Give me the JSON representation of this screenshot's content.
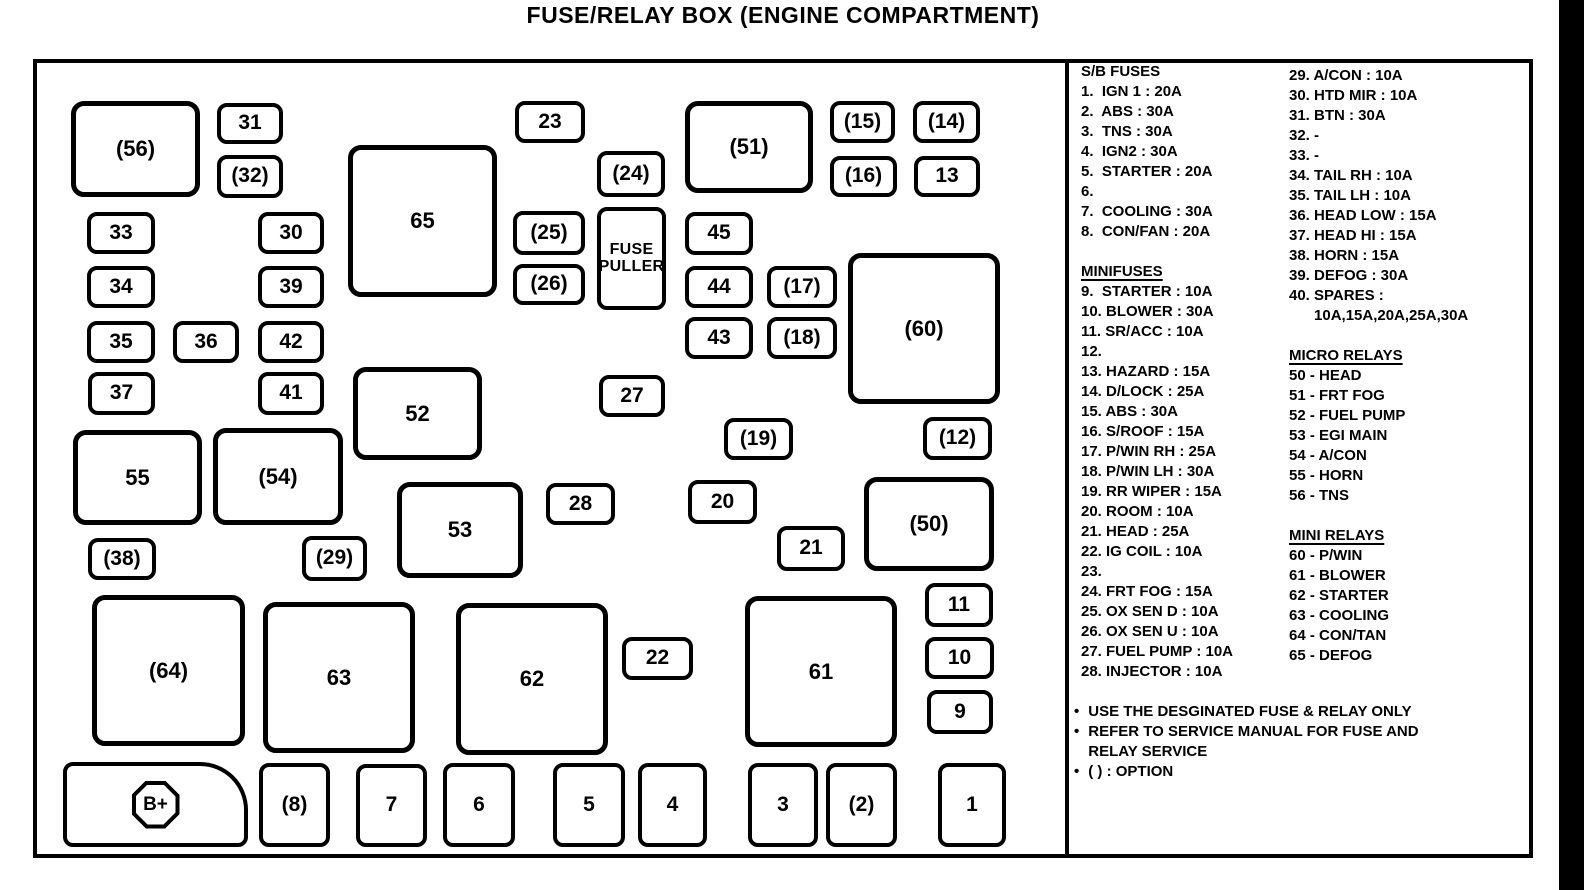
{
  "title": "FUSE/RELAY BOX (ENGINE COMPARTMENT)",
  "colors": {
    "ink": "#000000",
    "paper": "#ffffff"
  },
  "boxes": [
    {
      "id": "56",
      "label": "(56)",
      "x": 71,
      "y": 101,
      "w": 129,
      "h": 96,
      "large": true
    },
    {
      "id": "31",
      "label": "31",
      "x": 217,
      "y": 103,
      "w": 66,
      "h": 41
    },
    {
      "id": "32",
      "label": "(32)",
      "x": 217,
      "y": 155,
      "w": 66,
      "h": 43
    },
    {
      "id": "33",
      "label": "33",
      "x": 87,
      "y": 212,
      "w": 68,
      "h": 42
    },
    {
      "id": "30",
      "label": "30",
      "x": 258,
      "y": 212,
      "w": 66,
      "h": 42
    },
    {
      "id": "34",
      "label": "34",
      "x": 87,
      "y": 266,
      "w": 68,
      "h": 42
    },
    {
      "id": "39",
      "label": "39",
      "x": 258,
      "y": 266,
      "w": 66,
      "h": 42
    },
    {
      "id": "35",
      "label": "35",
      "x": 87,
      "y": 321,
      "w": 68,
      "h": 42
    },
    {
      "id": "36",
      "label": "36",
      "x": 173,
      "y": 321,
      "w": 66,
      "h": 42
    },
    {
      "id": "42",
      "label": "42",
      "x": 258,
      "y": 321,
      "w": 66,
      "h": 42
    },
    {
      "id": "37",
      "label": "37",
      "x": 88,
      "y": 372,
      "w": 67,
      "h": 43
    },
    {
      "id": "41",
      "label": "41",
      "x": 258,
      "y": 372,
      "w": 66,
      "h": 43
    },
    {
      "id": "65",
      "label": "65",
      "x": 348,
      "y": 145,
      "w": 149,
      "h": 152,
      "large": true
    },
    {
      "id": "52",
      "label": "52",
      "x": 353,
      "y": 367,
      "w": 129,
      "h": 93,
      "large": true
    },
    {
      "id": "23",
      "label": "23",
      "x": 515,
      "y": 101,
      "w": 70,
      "h": 42
    },
    {
      "id": "24",
      "label": "(24)",
      "x": 597,
      "y": 151,
      "w": 68,
      "h": 46
    },
    {
      "id": "51",
      "label": "(51)",
      "x": 685,
      "y": 101,
      "w": 128,
      "h": 92,
      "large": true
    },
    {
      "id": "15",
      "label": "(15)",
      "x": 830,
      "y": 101,
      "w": 65,
      "h": 42
    },
    {
      "id": "14",
      "label": "(14)",
      "x": 913,
      "y": 101,
      "w": 67,
      "h": 42
    },
    {
      "id": "16",
      "label": "(16)",
      "x": 830,
      "y": 156,
      "w": 67,
      "h": 41
    },
    {
      "id": "13",
      "label": "13",
      "x": 914,
      "y": 156,
      "w": 66,
      "h": 41
    },
    {
      "id": "25",
      "label": "(25)",
      "x": 513,
      "y": 211,
      "w": 72,
      "h": 44
    },
    {
      "id": "fuse-puller",
      "label": "FUSE PULLER",
      "lines": [
        "FUSE",
        "PULLER"
      ],
      "x": 597,
      "y": 207,
      "w": 69,
      "h": 103,
      "puller": true
    },
    {
      "id": "45",
      "label": "45",
      "x": 685,
      "y": 212,
      "w": 68,
      "h": 43
    },
    {
      "id": "26",
      "label": "(26)",
      "x": 513,
      "y": 264,
      "w": 72,
      "h": 41
    },
    {
      "id": "44",
      "label": "44",
      "x": 685,
      "y": 266,
      "w": 68,
      "h": 42
    },
    {
      "id": "17",
      "label": "(17)",
      "x": 767,
      "y": 266,
      "w": 70,
      "h": 42
    },
    {
      "id": "43",
      "label": "43",
      "x": 685,
      "y": 317,
      "w": 68,
      "h": 42
    },
    {
      "id": "18",
      "label": "(18)",
      "x": 767,
      "y": 317,
      "w": 70,
      "h": 42
    },
    {
      "id": "60",
      "label": "(60)",
      "x": 848,
      "y": 253,
      "w": 152,
      "h": 151,
      "large": true
    },
    {
      "id": "27",
      "label": "27",
      "x": 599,
      "y": 375,
      "w": 66,
      "h": 42
    },
    {
      "id": "19",
      "label": "(19)",
      "x": 724,
      "y": 418,
      "w": 69,
      "h": 42
    },
    {
      "id": "12",
      "label": "(12)",
      "x": 923,
      "y": 417,
      "w": 69,
      "h": 43
    },
    {
      "id": "55",
      "label": "55",
      "x": 73,
      "y": 430,
      "w": 129,
      "h": 95,
      "large": true
    },
    {
      "id": "54",
      "label": "(54)",
      "x": 213,
      "y": 428,
      "w": 130,
      "h": 97,
      "large": true
    },
    {
      "id": "53",
      "label": "53",
      "x": 397,
      "y": 482,
      "w": 126,
      "h": 96,
      "large": true
    },
    {
      "id": "28",
      "label": "28",
      "x": 546,
      "y": 483,
      "w": 69,
      "h": 42
    },
    {
      "id": "20",
      "label": "20",
      "x": 688,
      "y": 480,
      "w": 69,
      "h": 44
    },
    {
      "id": "21",
      "label": "21",
      "x": 777,
      "y": 526,
      "w": 68,
      "h": 45
    },
    {
      "id": "50",
      "label": "(50)",
      "x": 864,
      "y": 477,
      "w": 130,
      "h": 94,
      "large": true
    },
    {
      "id": "38",
      "label": "(38)",
      "x": 88,
      "y": 538,
      "w": 68,
      "h": 42
    },
    {
      "id": "29",
      "label": "(29)",
      "x": 302,
      "y": 536,
      "w": 65,
      "h": 45
    },
    {
      "id": "11",
      "label": "11",
      "x": 925,
      "y": 583,
      "w": 68,
      "h": 44
    },
    {
      "id": "10",
      "label": "10",
      "x": 925,
      "y": 637,
      "w": 69,
      "h": 42
    },
    {
      "id": "9",
      "label": "9",
      "x": 927,
      "y": 690,
      "w": 66,
      "h": 44
    },
    {
      "id": "64",
      "label": "(64)",
      "x": 92,
      "y": 595,
      "w": 153,
      "h": 151,
      "large": true
    },
    {
      "id": "63",
      "label": "63",
      "x": 263,
      "y": 602,
      "w": 152,
      "h": 151,
      "large": true
    },
    {
      "id": "62",
      "label": "62",
      "x": 456,
      "y": 603,
      "w": 152,
      "h": 152,
      "large": true
    },
    {
      "id": "22",
      "label": "22",
      "x": 622,
      "y": 637,
      "w": 71,
      "h": 43
    },
    {
      "id": "61",
      "label": "61",
      "x": 745,
      "y": 596,
      "w": 152,
      "h": 151,
      "large": true
    },
    {
      "id": "battery",
      "label": "B+",
      "battery": true,
      "x": 63,
      "y": 762,
      "w": 185,
      "h": 85
    },
    {
      "id": "8",
      "label": "(8)",
      "x": 259,
      "y": 763,
      "w": 71,
      "h": 84
    },
    {
      "id": "7",
      "label": "7",
      "x": 356,
      "y": 764,
      "w": 71,
      "h": 83
    },
    {
      "id": "6",
      "label": "6",
      "x": 443,
      "y": 763,
      "w": 72,
      "h": 84
    },
    {
      "id": "5",
      "label": "5",
      "x": 553,
      "y": 763,
      "w": 72,
      "h": 84
    },
    {
      "id": "4",
      "label": "4",
      "x": 638,
      "y": 763,
      "w": 69,
      "h": 84
    },
    {
      "id": "3",
      "label": "3",
      "x": 748,
      "y": 763,
      "w": 70,
      "h": 84
    },
    {
      "id": "2",
      "label": "(2)",
      "x": 826,
      "y": 763,
      "w": 71,
      "h": 84
    },
    {
      "id": "1",
      "label": "1",
      "x": 938,
      "y": 763,
      "w": 68,
      "h": 84
    }
  ],
  "legend": {
    "column1": [
      {
        "text": "S/B FUSES",
        "header": true,
        "underline": false
      },
      {
        "text": "1.  IGN 1 : 20A"
      },
      {
        "text": "2.  ABS : 30A"
      },
      {
        "text": "3.  TNS : 30A"
      },
      {
        "text": "4.  IGN2 : 30A"
      },
      {
        "text": "5.  STARTER : 20A"
      },
      {
        "text": "6."
      },
      {
        "text": "7.  COOLING : 30A"
      },
      {
        "text": "8.  CON/FAN : 20A"
      },
      {
        "text": ""
      },
      {
        "text": "MINIFUSES",
        "header": true,
        "underline": true
      },
      {
        "text": "9.  STARTER : 10A"
      },
      {
        "text": "10. BLOWER : 30A"
      },
      {
        "text": "11. SR/ACC : 10A"
      },
      {
        "text": "12."
      },
      {
        "text": "13. HAZARD : 15A"
      },
      {
        "text": "14. D/LOCK : 25A"
      },
      {
        "text": "15. ABS : 30A"
      },
      {
        "text": "16. S/ROOF : 15A"
      },
      {
        "text": "17. P/WIN RH : 25A"
      },
      {
        "text": "18. P/WIN LH : 30A"
      },
      {
        "text": "19. RR WIPER : 15A"
      },
      {
        "text": "20. ROOM : 10A"
      },
      {
        "text": "21. HEAD : 25A"
      },
      {
        "text": "22. IG COIL : 10A"
      },
      {
        "text": "23."
      },
      {
        "text": "24. FRT FOG : 15A"
      },
      {
        "text": "25. OX SEN D : 10A"
      },
      {
        "text": "26. OX SEN U : 10A"
      },
      {
        "text": "27. FUEL PUMP : 10A"
      },
      {
        "text": "28. INJECTOR : 10A"
      }
    ],
    "column2": [
      {
        "text": "29. A/CON : 10A"
      },
      {
        "text": "30. HTD MIR : 10A"
      },
      {
        "text": "31. BTN : 30A"
      },
      {
        "text": "32. -"
      },
      {
        "text": "33. -"
      },
      {
        "text": "34. TAIL RH : 10A"
      },
      {
        "text": "35. TAIL LH : 10A"
      },
      {
        "text": "36. HEAD LOW : 15A"
      },
      {
        "text": "37. HEAD HI : 15A"
      },
      {
        "text": "38. HORN : 15A"
      },
      {
        "text": "39. DEFOG : 30A"
      },
      {
        "text": "40. SPARES :"
      },
      {
        "text": "      10A,15A,20A,25A,30A"
      },
      {
        "text": ""
      },
      {
        "text": "MICRO RELAYS",
        "header": true,
        "underline": true
      },
      {
        "text": "50 - HEAD"
      },
      {
        "text": "51 - FRT FOG"
      },
      {
        "text": "52 - FUEL PUMP"
      },
      {
        "text": "53 - EGI MAIN"
      },
      {
        "text": "54 - A/CON"
      },
      {
        "text": "55 - HORN"
      },
      {
        "text": "56 - TNS"
      },
      {
        "text": ""
      },
      {
        "text": "MINI RELAYS",
        "header": true,
        "underline": true
      },
      {
        "text": "60 - P/WIN"
      },
      {
        "text": "61 - BLOWER"
      },
      {
        "text": "62 - STARTER"
      },
      {
        "text": "63 - COOLING"
      },
      {
        "text": "64 - CON/TAN"
      },
      {
        "text": "65 - DEFOG"
      }
    ]
  },
  "notes": [
    {
      "lines": [
        "USE THE DESGINATED FUSE & RELAY ONLY"
      ]
    },
    {
      "lines": [
        "REFER TO SERVICE MANUAL FOR FUSE AND",
        "RELAY SERVICE"
      ]
    },
    {
      "lines": [
        "(  ) :  OPTION"
      ]
    }
  ],
  "note_bullet": "•"
}
